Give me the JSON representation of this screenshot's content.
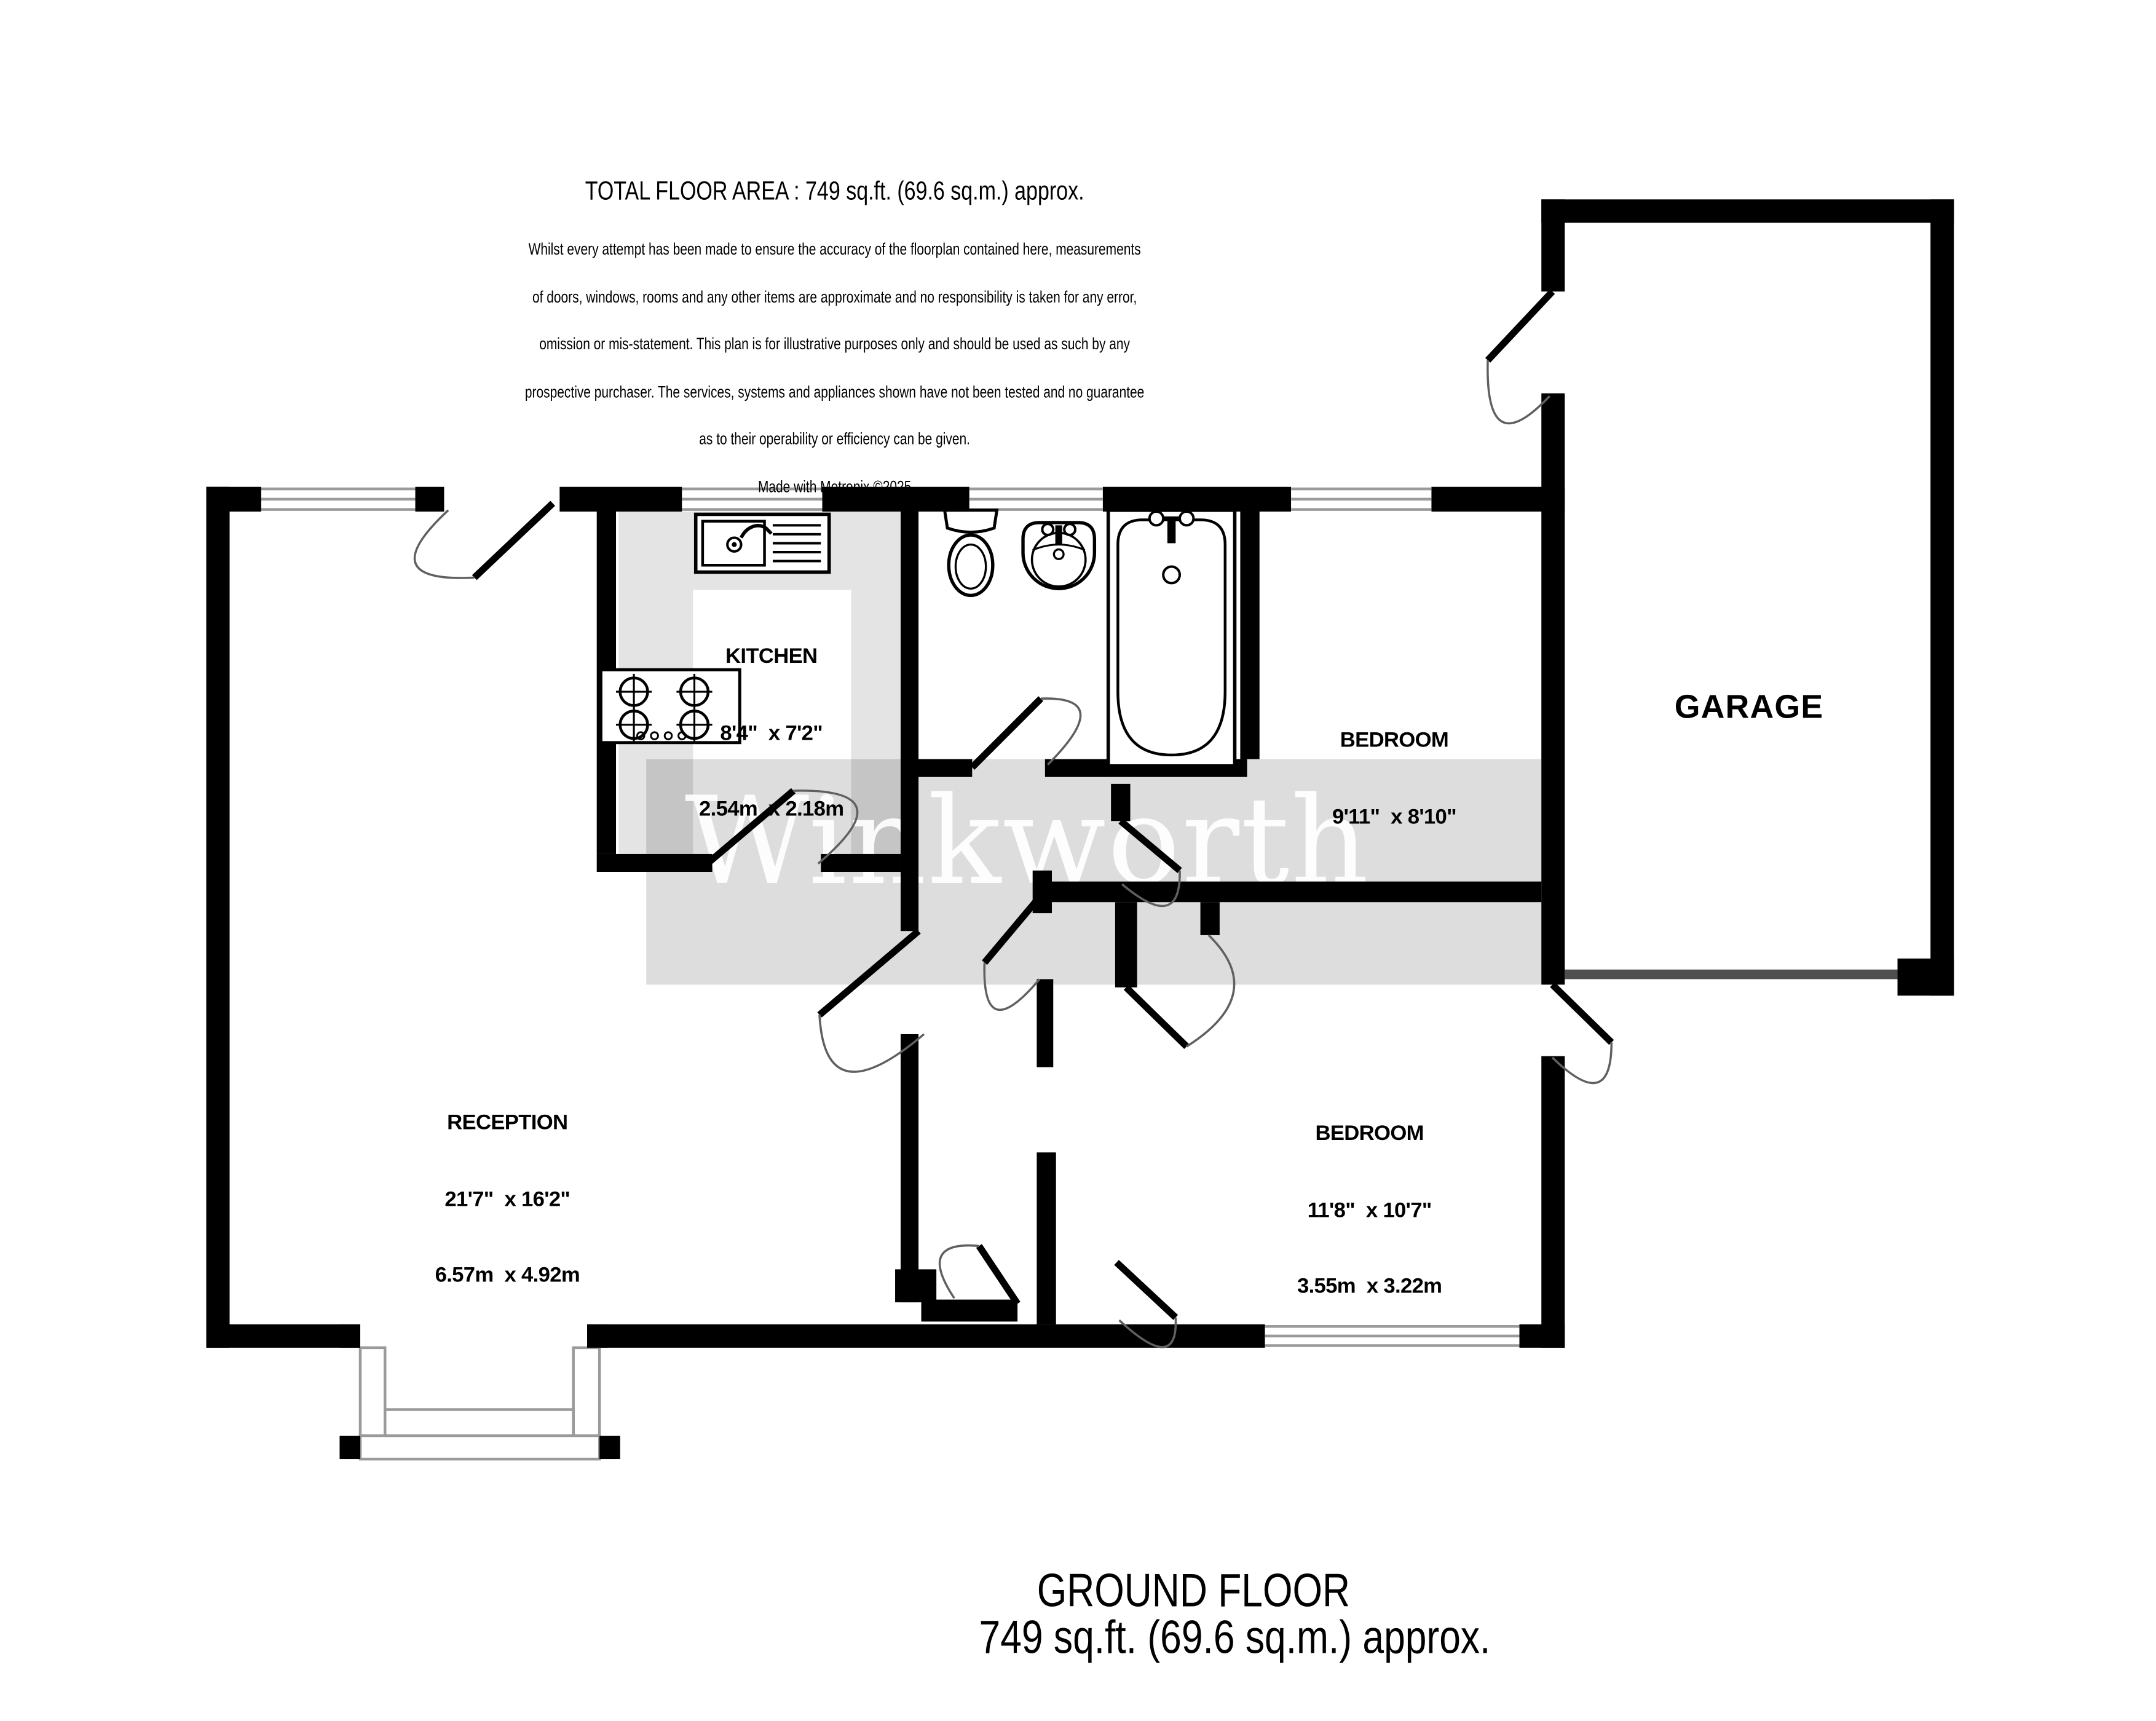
{
  "header": {
    "title": "TOTAL FLOOR AREA : 749 sq.ft. (69.6 sq.m.) approx.",
    "disclaimer_lines": [
      "Whilst every attempt has been made to ensure the accuracy of the floorplan contained here, measurements",
      "of doors, windows, rooms and any other items are approximate and no responsibility is taken for any error,",
      "omission or mis-statement. This plan is for illustrative purposes only and should be used as such by any",
      "prospective purchaser. The services, systems and appliances shown have not been tested and no guarantee",
      "as to their operability or efficiency can be given."
    ],
    "credit": "Made with Metropix ©2025"
  },
  "footer": {
    "floor_label": "GROUND FLOOR",
    "area_label": "749 sq.ft. (69.6 sq.m.) approx."
  },
  "watermark": {
    "text": "Winkworth"
  },
  "rooms": {
    "kitchen": {
      "name": "KITCHEN",
      "imperial": "8'4\"  x 7'2\"",
      "metric": "2.54m  x 2.18m"
    },
    "bedroom1": {
      "name": "BEDROOM",
      "imperial": "9'11\"  x 8'10\"",
      "metric": "3.03m  x 2.69m"
    },
    "reception": {
      "name": "RECEPTION",
      "imperial": "21'7\"  x 16'2\"",
      "metric": "6.57m  x 4.92m"
    },
    "bedroom2": {
      "name": "BEDROOM",
      "imperial": "11'8\"  x 10'7\"",
      "metric": "3.55m  x 3.22m"
    },
    "garage": {
      "name": "GARAGE"
    }
  },
  "colors": {
    "wall": "#000000",
    "kitchen_floor": "#e4e4e4",
    "watermark_band": "#dcdcdc",
    "watermark_text": "#ffffff",
    "window_line": "#9a9a9a",
    "door_arc": "#606060",
    "garage_door_line": "#4f4f4f"
  }
}
